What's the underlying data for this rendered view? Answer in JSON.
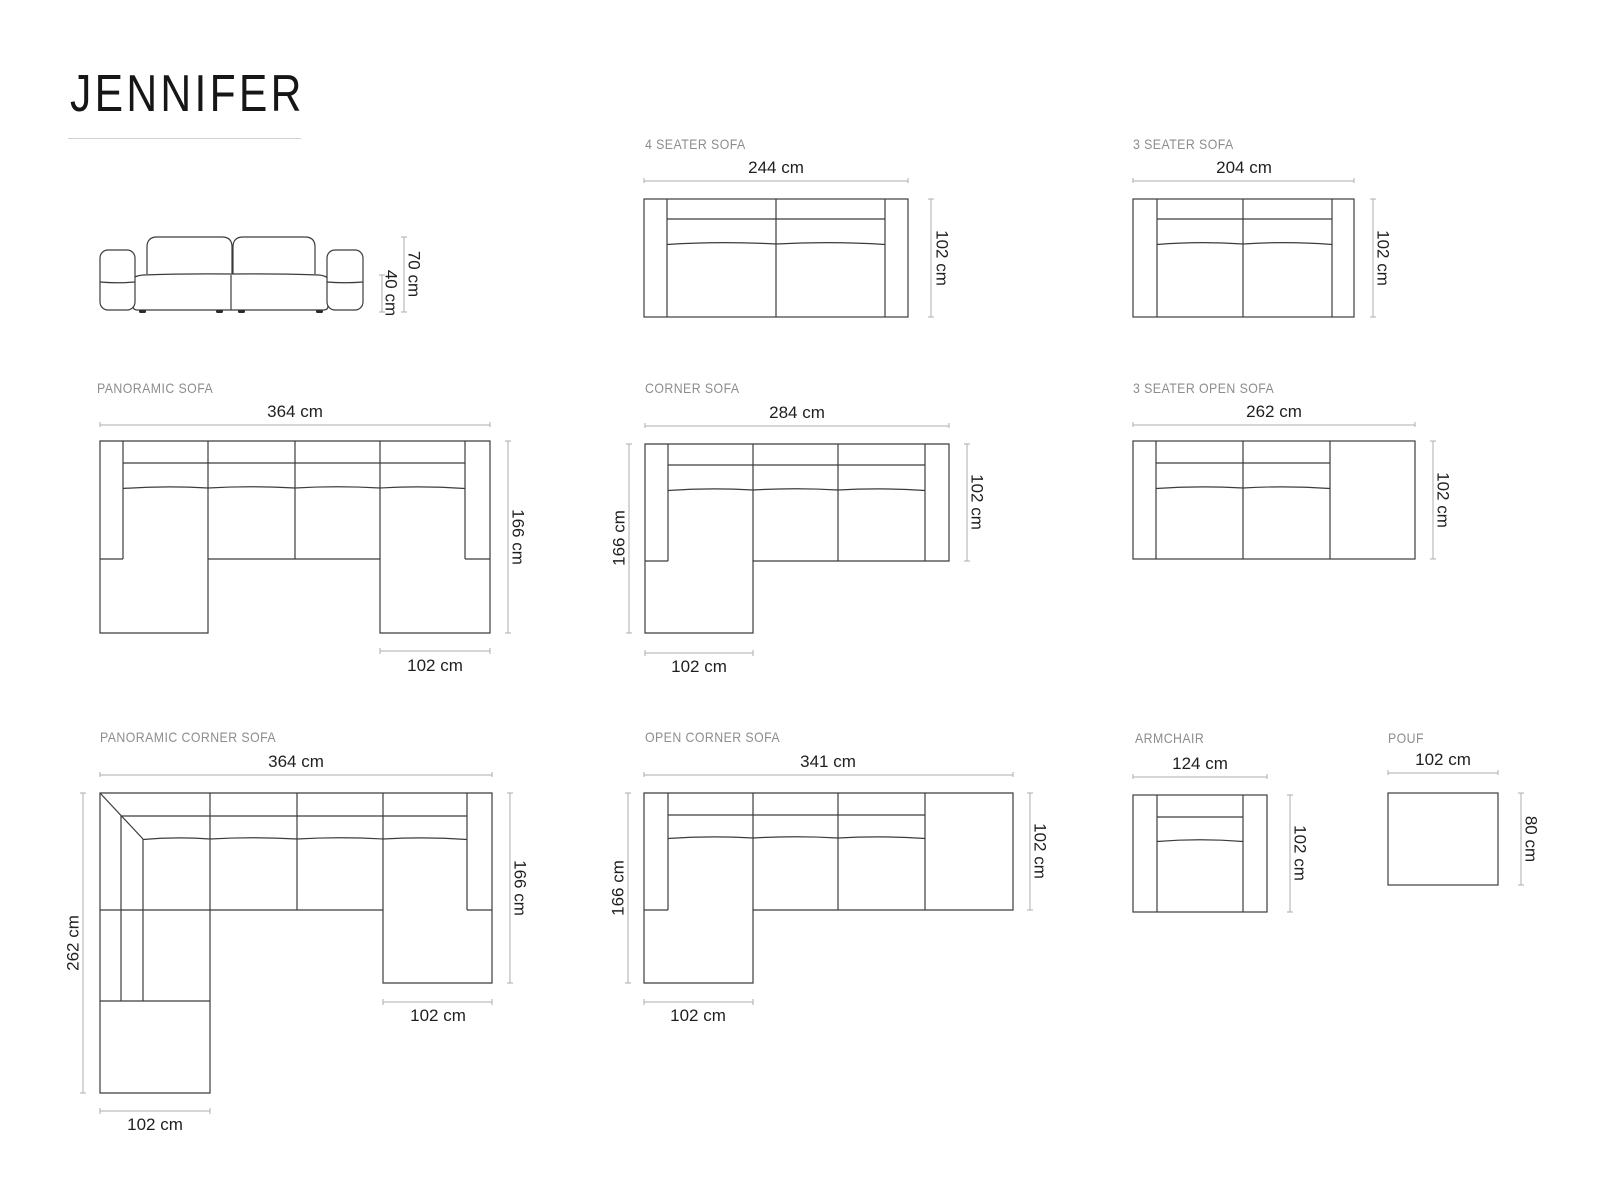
{
  "page": {
    "title": "JENNIFER"
  },
  "colors": {
    "outline": "#3c3c3c",
    "dimension_line": "#adadad",
    "dimension_text": "#1f1f1f",
    "label_text": "#8d8d8d"
  },
  "diagrams": {
    "side_view": {
      "total_height": "70 cm",
      "seat_height": "40 cm"
    },
    "four_seater": {
      "label": "4 SEATER SOFA",
      "width": "244 cm",
      "depth": "102 cm"
    },
    "three_seater": {
      "label": "3 SEATER SOFA",
      "width": "204 cm",
      "depth": "102 cm"
    },
    "panoramic": {
      "label": "PANORAMIC SOFA",
      "width": "364 cm",
      "depth": "166 cm",
      "chaise_width": "102 cm"
    },
    "corner": {
      "label": "CORNER SOFA",
      "width": "284 cm",
      "depth": "102 cm",
      "side_depth": "166 cm",
      "chaise_width": "102 cm"
    },
    "three_seater_open": {
      "label": "3 SEATER OPEN SOFA",
      "width": "262 cm",
      "depth": "102 cm"
    },
    "panoramic_corner": {
      "label": "PANORAMIC CORNER SOFA",
      "width": "364 cm",
      "left_depth": "262 cm",
      "right_depth": "166 cm",
      "right_chaise_width": "102 cm",
      "bottom_chaise_width": "102 cm"
    },
    "open_corner": {
      "label": "OPEN CORNER SOFA",
      "width": "341 cm",
      "side_depth": "166 cm",
      "depth": "102 cm",
      "chaise_width": "102 cm"
    },
    "armchair": {
      "label": "ARMCHAIR",
      "width": "124 cm",
      "depth": "102 cm"
    },
    "pouf": {
      "label": "POUF",
      "width": "102 cm",
      "depth": "80 cm"
    }
  }
}
